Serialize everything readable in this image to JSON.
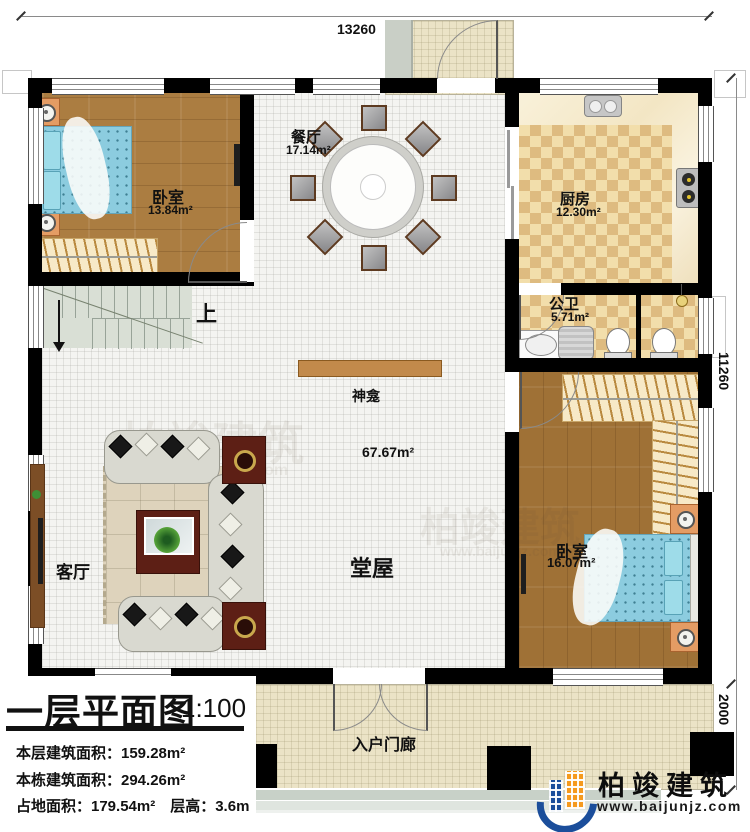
{
  "dimensions": {
    "top": "13260",
    "right": "11260",
    "right_porch": "2000"
  },
  "rooms": {
    "bedroom1": {
      "name": "卧室",
      "area": "13.84m²"
    },
    "dining": {
      "name": "餐厅",
      "area": "17.14m²"
    },
    "kitchen": {
      "name": "厨房",
      "area": "12.30m²"
    },
    "bathroom": {
      "name": "公卫",
      "area": "5.71m²"
    },
    "bedroom2": {
      "name": "卧室",
      "area": "16.07m²"
    },
    "hall": {
      "name": "堂屋",
      "area": "67.67m²"
    },
    "living": {
      "name": "客厅"
    },
    "shrine": {
      "name": "神龛"
    },
    "stairs": {
      "up_label": "上"
    },
    "entry_porch": {
      "name": "入户门廊"
    }
  },
  "title_block": {
    "title": "一层平面图",
    "scale": "1:100",
    "rows": [
      "本层建筑面积：159.28m²",
      "本栋建筑面积：294.26m²",
      "占地面积：179.54m²　层高：3.6m"
    ]
  },
  "logo": {
    "company": "柏竣建筑",
    "website": "www.baijunjz.com"
  },
  "colors": {
    "wall": "#000000",
    "wood_floor": "#ab7d41",
    "tile_light": "#f2deab",
    "tile_dark": "#debb80",
    "bed_blue": "#8cccdf",
    "logo_blue": "#1b4e9b",
    "logo_orange": "#f59a1e"
  }
}
